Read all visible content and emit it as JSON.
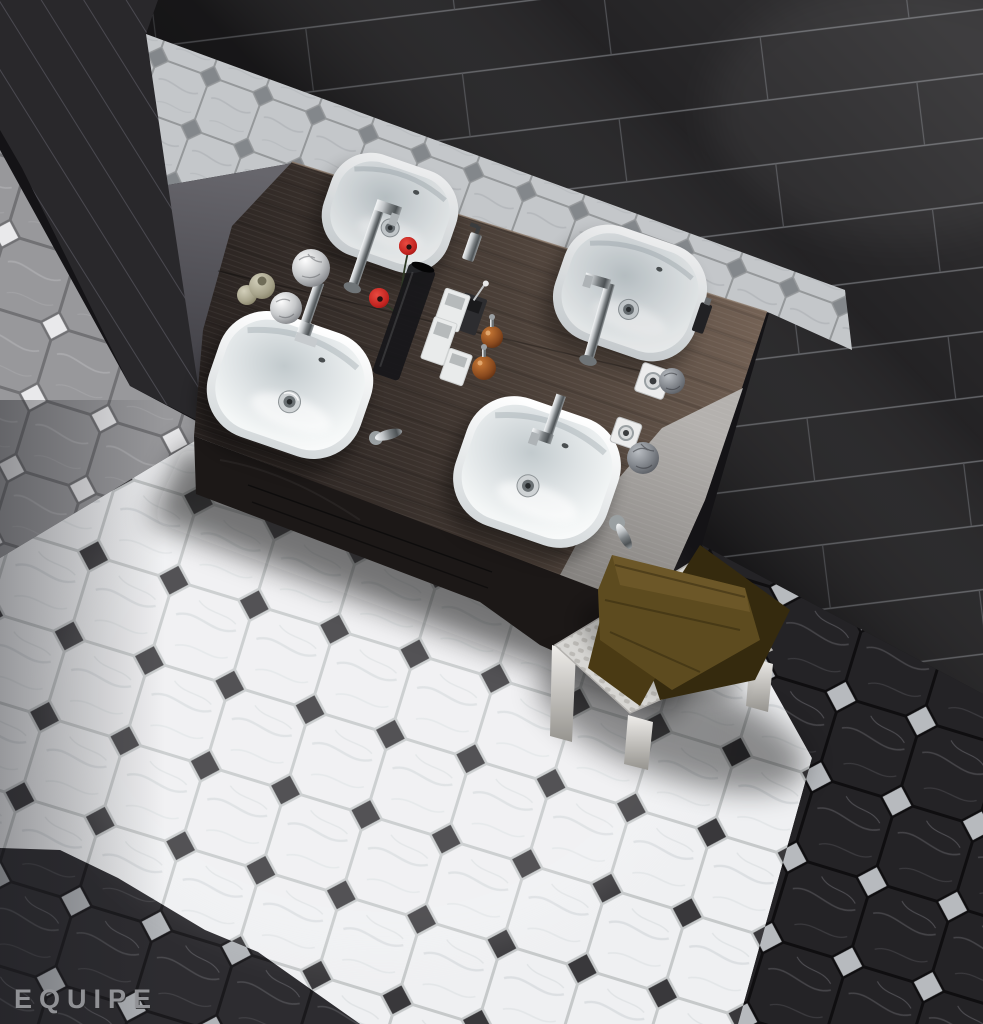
{
  "meta": {
    "type": "product-render",
    "description": "Overhead showroom render of a bathroom: dark wenge double vanity with four white vessel basins and chrome taps, black gloss plank wall tiles, an octagon-and-dot marble mosaic floor shown in grey, white and black colourways, and a white croc-leather stool with folded brown towels.",
    "width": 983,
    "height": 1024
  },
  "brand": {
    "logo_text": "EQUIPE",
    "logo_color": "#96979b"
  },
  "palette": {
    "background": "#141316",
    "wall": "#1f1e20",
    "wall_grout": "#63646a",
    "side_wall": "#29282b",
    "counter_dark": "#2a2321",
    "counter_light": "#6e5c51",
    "cabinet_panel": "#a7a4a1",
    "floor_white": "#eff0f2",
    "floor_white_grout": "#c6c9ca",
    "floor_dot_dark": "#39383b",
    "floor_black": "#252427",
    "floor_black_grout": "#0f0e10",
    "floor_dot_silver": "#b7babe",
    "floor_grey": "#98989b",
    "floor_dot_white": "#e9e9eb",
    "basin_white": "#ffffff",
    "chrome": "#c3c7ca",
    "towel_olive": "#5d4b1f",
    "towel_dark": "#352a0e",
    "stool": "#d7d6d3",
    "poppy_red": "#c22420",
    "amber": "#8a4a1e",
    "vase_glass": "#17171a"
  },
  "scene": {
    "walls": {
      "back_wall": "black gloss plank tiles with light grout",
      "side_wall": "dark plank tiles seen edge-on",
      "border_strip": "white octagon mosaic strip with grey dot inserts (mirror strip)"
    },
    "vanity": {
      "counter": "dark wenge wood double counter",
      "sink_count": 4,
      "sinks": [
        "back-left basin",
        "back-right basin",
        "front-left basin",
        "front-right basin"
      ],
      "faucet_count": 4,
      "faucet_finish": "chrome"
    },
    "floor": {
      "pattern": "octagon marble mosaic with square dot inserts",
      "zones": [
        "grey octagons with white dots (upper left)",
        "white octagons with black dots (lit centre)",
        "black octagons with silver dots (right side and lower-left corner)"
      ]
    },
    "stool": {
      "material": "white croc-embossed leather",
      "towels": [
        "olive brown folded towel",
        "dark brown folded towel"
      ]
    },
    "accessories": [
      "silver crackle sphere",
      "silver crackle sphere",
      "green glass jar",
      "green glass jar",
      "dark glass flower vase",
      "red poppy flower",
      "red poppy flower",
      "white square tumbler",
      "white square tumbler",
      "white square tumbler",
      "black square tumbler",
      "amber soap jar with pump",
      "amber soap jar with pump",
      "chrome soap dispenser",
      "dark glass bottle",
      "chrome mixer dial on white plate",
      "chrome mixer dial on white plate",
      "chrome lever handle",
      "chrome lever handle",
      "dark crackle sphere",
      "silver crackle sphere"
    ]
  }
}
